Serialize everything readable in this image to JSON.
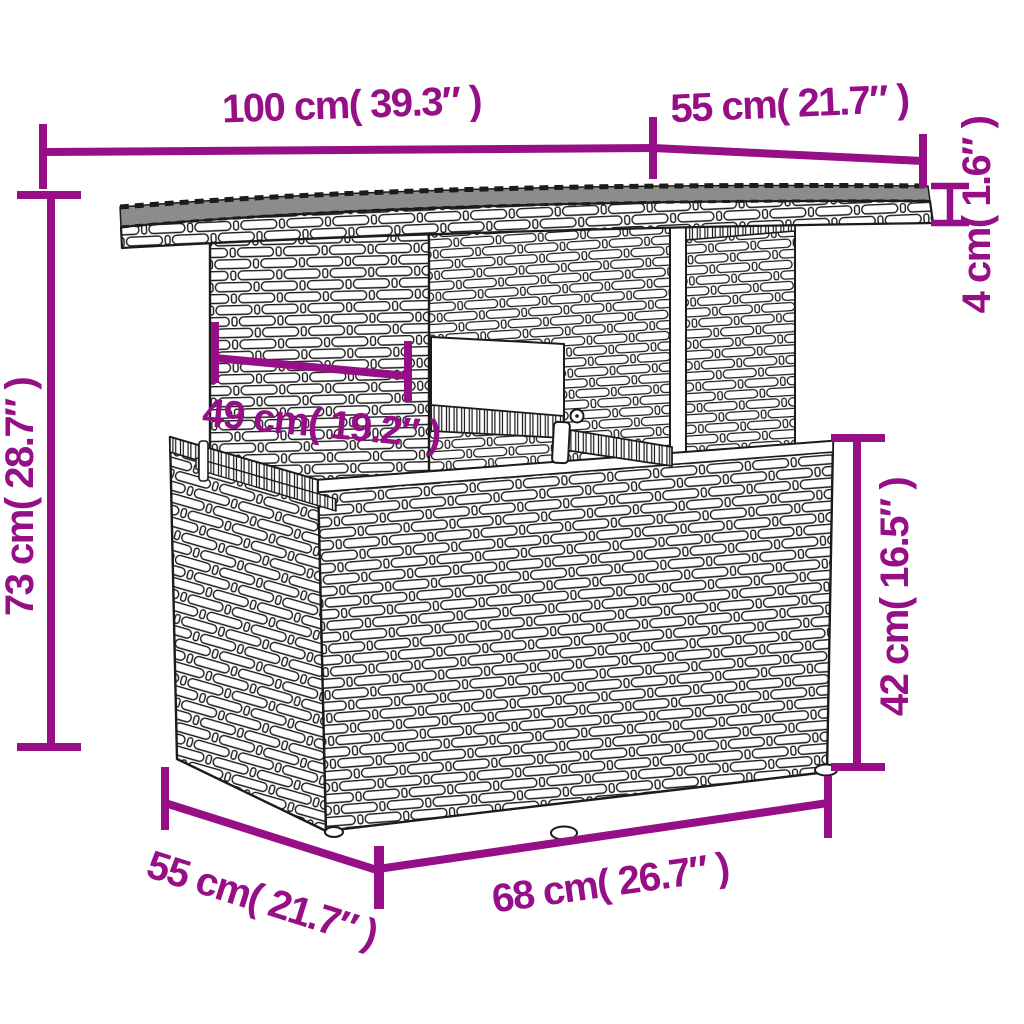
{
  "diagram": {
    "type": "furniture-dimension-diagram",
    "subject": "rattan-garden-table",
    "colors": {
      "dimension": "#970f86",
      "outline": "#1b1b1b",
      "glass_top": "#8c8c8c",
      "background": "#ffffff"
    },
    "labels": {
      "top_width": "100 cm( 39.3″ )",
      "top_depth": "55 cm( 21.7″ )",
      "top_thickness": "4 cm( 1.6″ )",
      "total_height": "73 cm( 28.7″ )",
      "pedestal_width": "49 cm( 19.2″ )",
      "base_height": "42 cm( 16.5″ )",
      "base_width": "68 cm( 26.7″ )",
      "base_depth": "55 cm( 21.7″ )"
    }
  }
}
